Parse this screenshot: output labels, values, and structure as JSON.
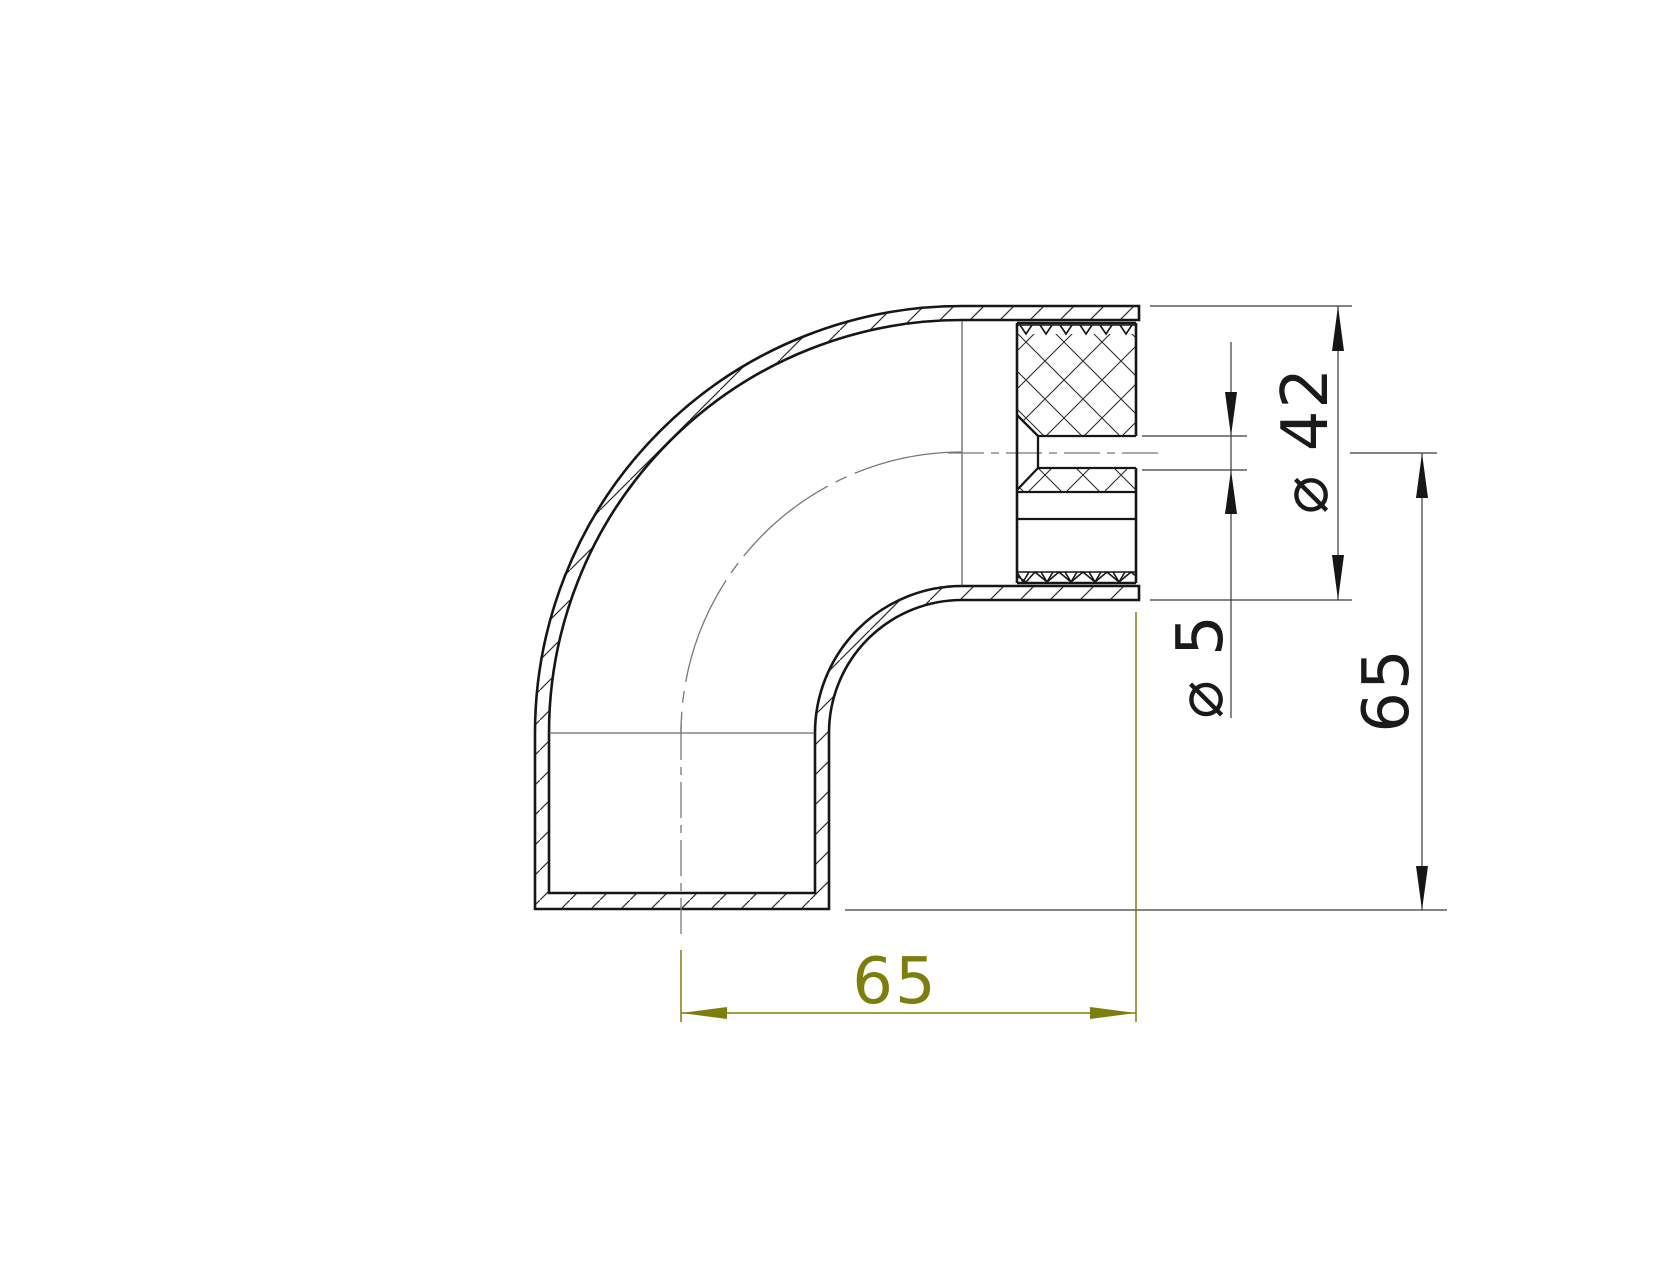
{
  "drawing": {
    "kind": "section view of 90-degree tube elbow with knurled insert",
    "background": "#ffffff",
    "colors": {
      "outline": "#161616",
      "thin_line": "#3a3a3a",
      "centerline": "#787878",
      "accent_olive": "#7e7e0e"
    },
    "dimensions": {
      "outer_diameter": {
        "label": "⌀ 42",
        "value": 42
      },
      "hole_diameter": {
        "label": "⌀ 5",
        "value": 5
      },
      "center_to_bottom": {
        "label": "65",
        "value": 65
      },
      "center_to_end": {
        "label": "65",
        "value": 65
      }
    }
  }
}
